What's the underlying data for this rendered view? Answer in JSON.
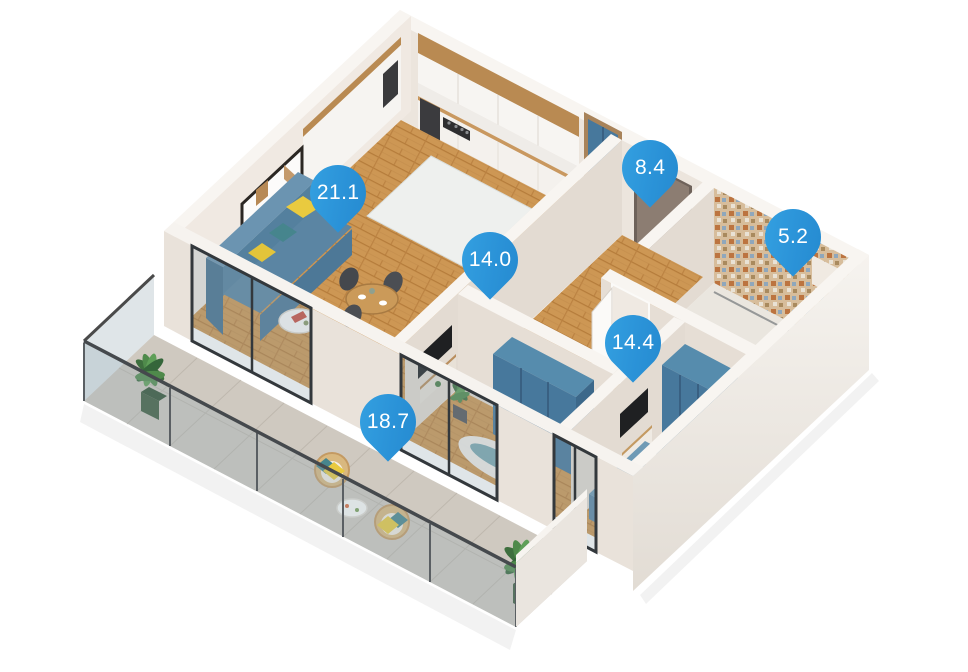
{
  "title": "3D apartment floor plan with room areas",
  "pins": [
    {
      "room": "living-kitchen",
      "area": "21.1"
    },
    {
      "room": "hallway",
      "area": "8.4"
    },
    {
      "room": "bathroom",
      "area": "5.2"
    },
    {
      "room": "bedroom-1",
      "area": "14.0"
    },
    {
      "room": "bedroom-2",
      "area": "14.4"
    },
    {
      "room": "balcony",
      "area": "18.7"
    }
  ],
  "colors": {
    "pin_blue": "#2b93d8",
    "pin_text": "#ffffff",
    "wood_floor": "#cd9754",
    "wall_cream": "#ece5dd",
    "wall_cap": "#f8f5f1",
    "wardrobe_blue": "#47789c",
    "sofa_blue": "#5b85a3",
    "balcony_tile": "#cfc9c0",
    "accent_yellow": "#e9ca3f",
    "accent_teal": "#46858d",
    "plant_green": "#4f8a4b",
    "entry_door_brown": "#8c7d72",
    "background": "#ffffff"
  }
}
